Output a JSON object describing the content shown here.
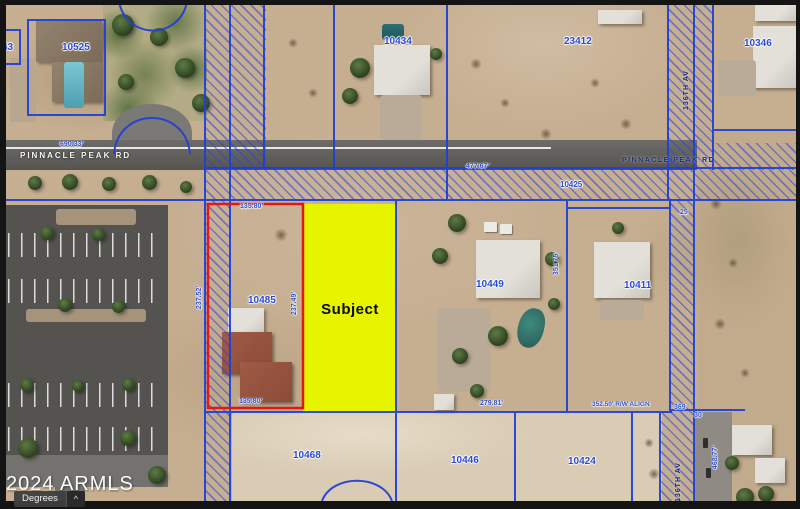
{
  "map": {
    "labels": {
      "parcels": [
        "43",
        "10525",
        "10434",
        "23412",
        "10346",
        "10425",
        "10485",
        "10449",
        "10411",
        "10468",
        "10446",
        "10424"
      ],
      "streets": {
        "pinnacle_west": "PINNACLE PEAK RD",
        "pinnacle_east": "PINNACLE PEAK RD",
        "av136_north": "136TH AV",
        "av136_south": "136TH AV"
      },
      "dimensions": {
        "pinnacle_row_west": "690.33'",
        "pinnacle_row_east": "477.67'",
        "red_top": "135.80'",
        "red_left": "237.52'",
        "red_right": "237.49'",
        "red_bottom": "135.80'",
        "lot10449_east": "351.75'",
        "lot10449_south": "279.81'",
        "south_align": "352.50' R/W ALIGN",
        "row_369": "369",
        "row_30": "30",
        "row_25": "25",
        "east_road": "468.77'"
      }
    },
    "subject": {
      "label": "Subject"
    },
    "watermark": "2024 ARMLS",
    "controls": {
      "degrees_label": "Degrees",
      "collapse_icon": "^"
    },
    "colors": {
      "subject_fill": "#e6f400",
      "subject_outline": "#e01818",
      "parcel_line": "#1e3fd8",
      "label_blue": "#2b49d8"
    }
  }
}
